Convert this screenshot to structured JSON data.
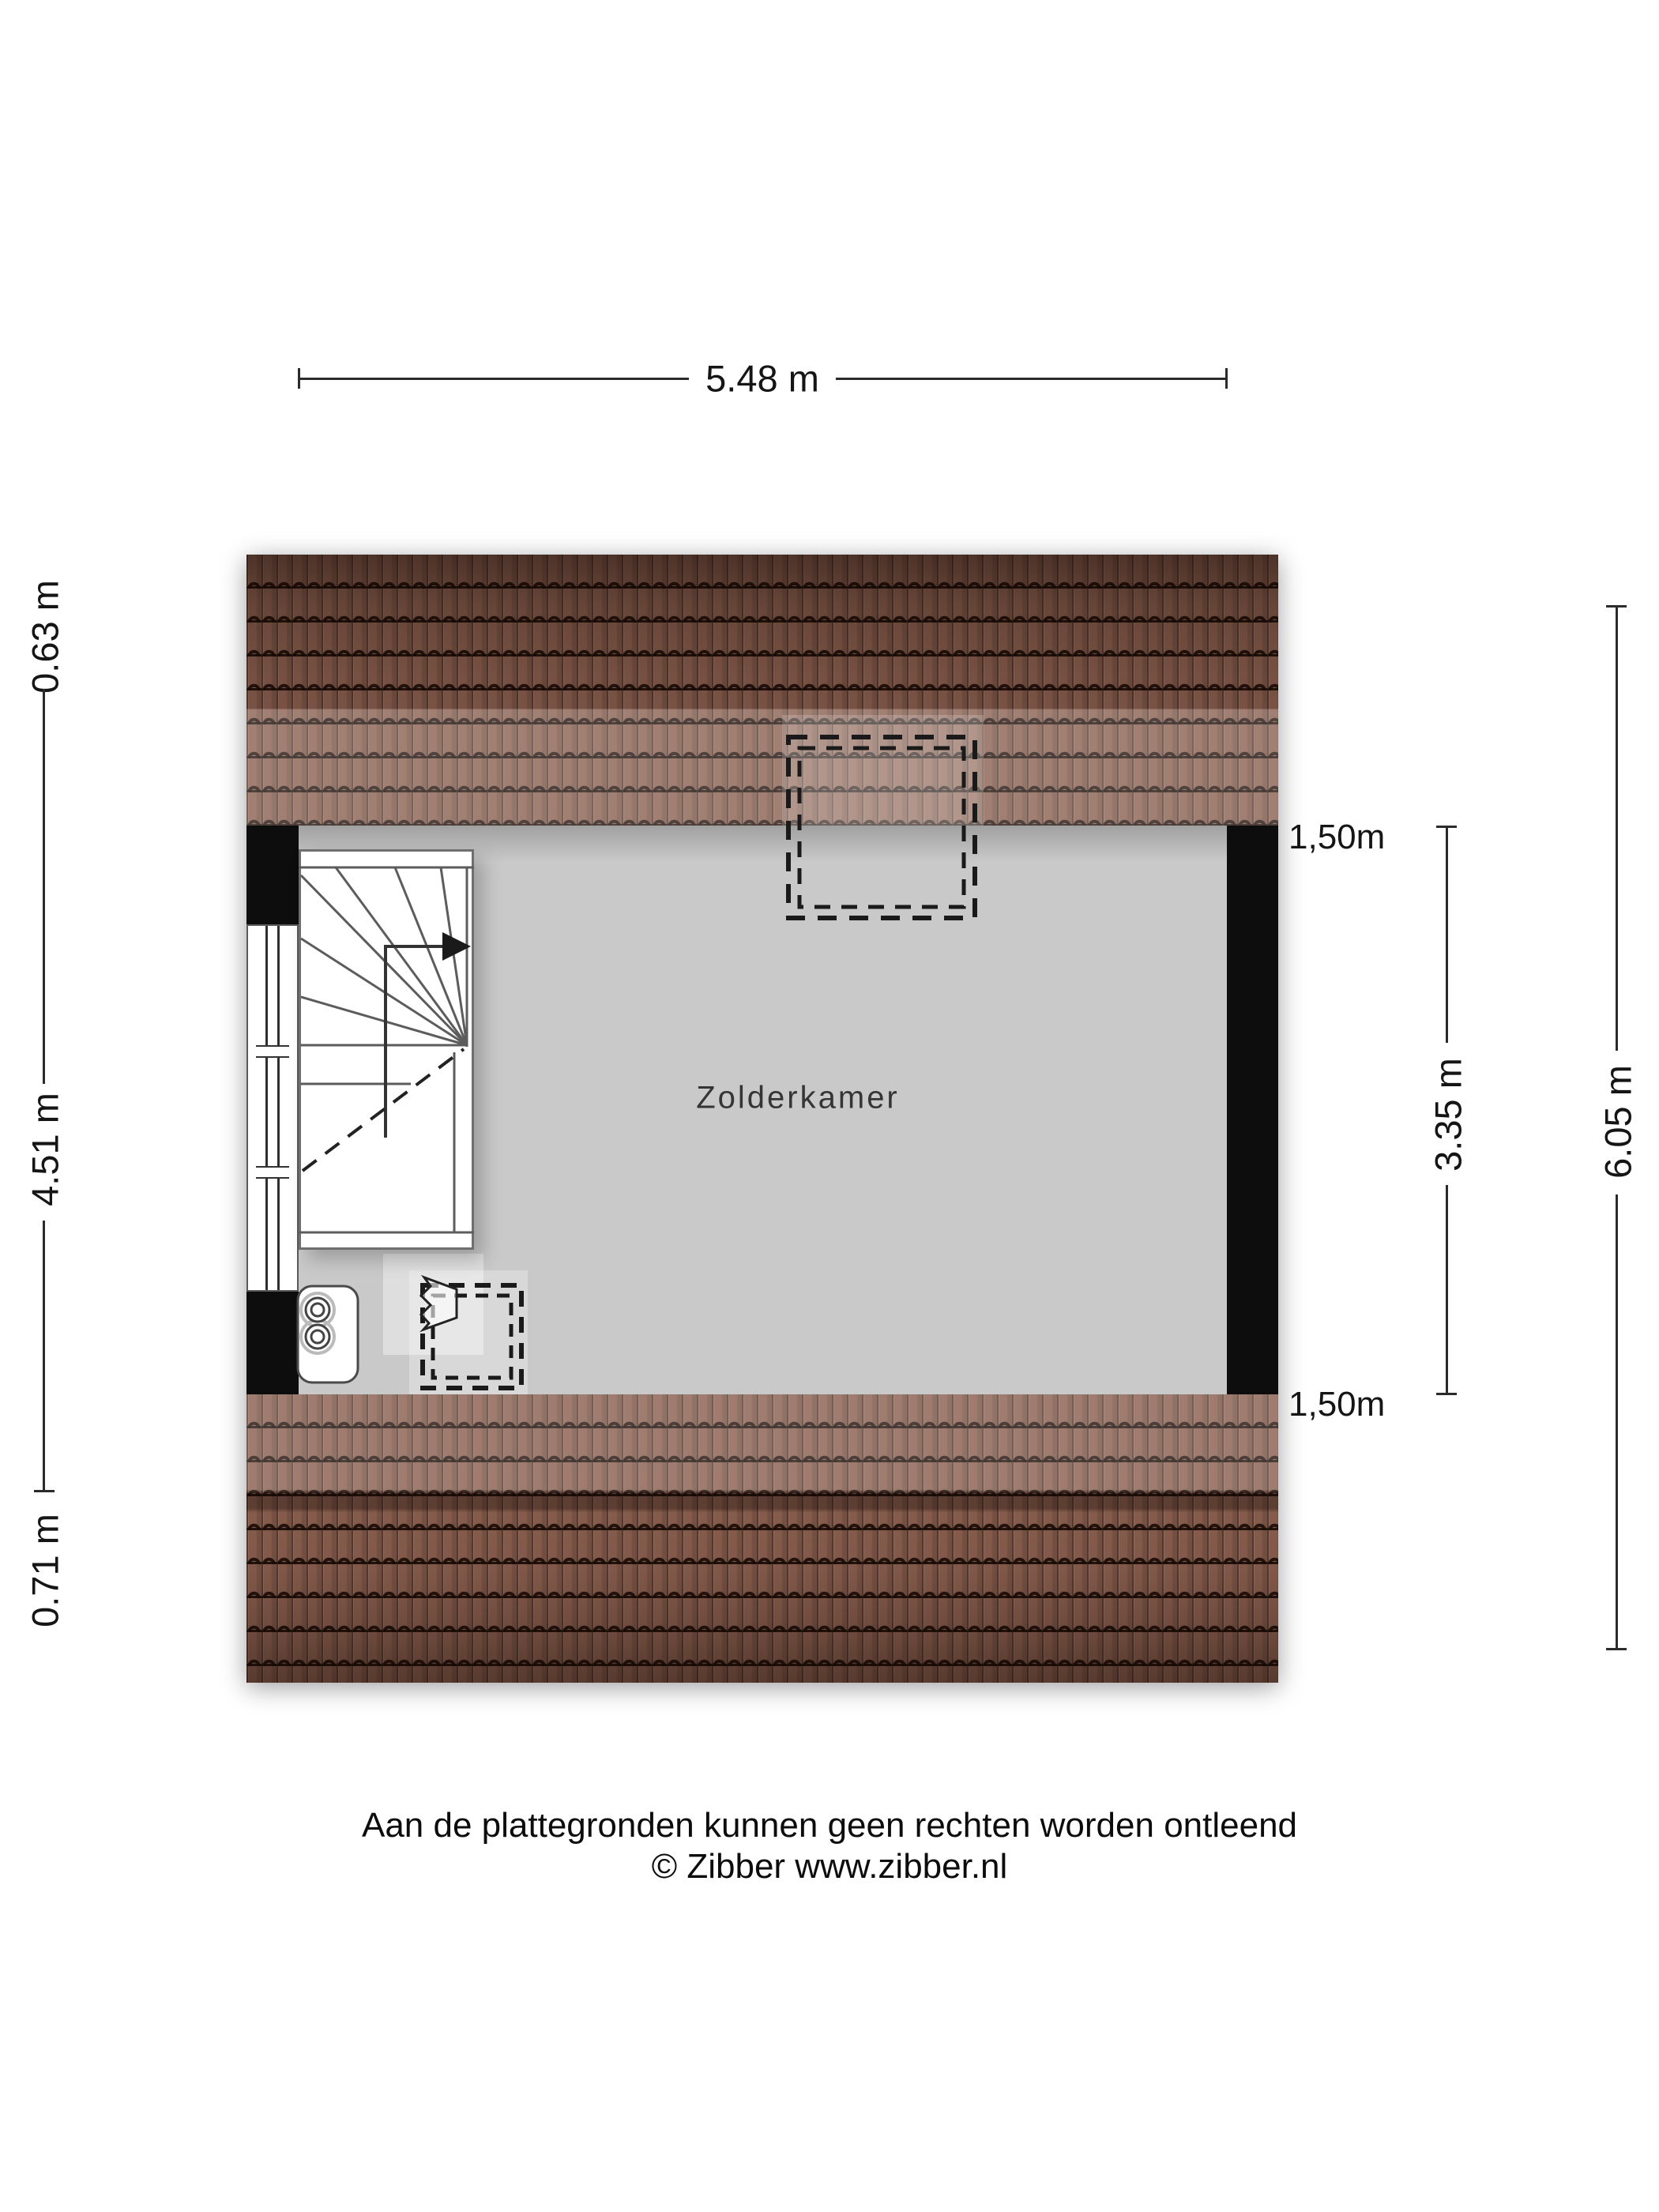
{
  "plan": {
    "room_label": "Zolderkamer",
    "colors": {
      "roof_tile": "#8a5f4f",
      "roof_joint": "#2a140d",
      "wall": "#0d0d0d",
      "floor": "#c9c9c9",
      "dimension_line": "#2b2b2b",
      "background": "#ffffff"
    }
  },
  "dimensions": {
    "top_width": "5.48 m",
    "left": {
      "top": "0.63 m",
      "middle": "4.51 m",
      "bottom": "0.71 m"
    },
    "right_inner": {
      "top": "1,50m",
      "middle": "3.35 m",
      "bottom": "1,50m"
    },
    "right_outer": "6.05 m"
  },
  "footer": {
    "line1": "Aan de plattegronden kunnen geen rechten worden ontleend",
    "line2": "© Zibber www.zibber.nl"
  }
}
